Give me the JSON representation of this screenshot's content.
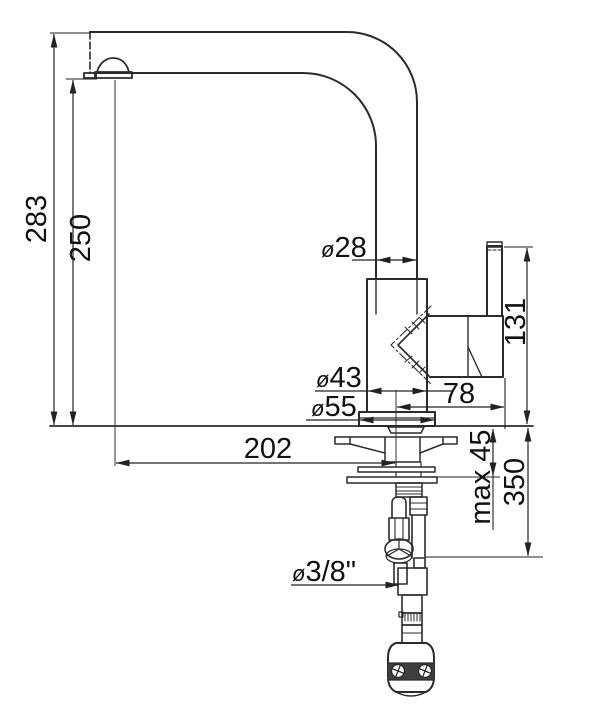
{
  "colors": {
    "background": "#ffffff",
    "object_line": "#2b2b2b",
    "dimension_line": "#222222",
    "text": "#111111",
    "weight_band": "#3f3f3f"
  },
  "drawing": {
    "type": "technical-dimension-drawing",
    "dims": {
      "total_height": "283",
      "spout_height": "250",
      "spout_tube_diameter": {
        "sym": "ø",
        "val": "28"
      },
      "handle_height": "131",
      "body_diameter": {
        "sym": "ø",
        "val": "43"
      },
      "handle_reach": "78",
      "base_diameter": {
        "sym": "ø",
        "val": "55"
      },
      "spout_reach": "202",
      "max_deck_thickness": "max 45",
      "below_deck_height": "350",
      "supply_connection": {
        "sym": "ø",
        "val": "3/8\""
      }
    }
  }
}
